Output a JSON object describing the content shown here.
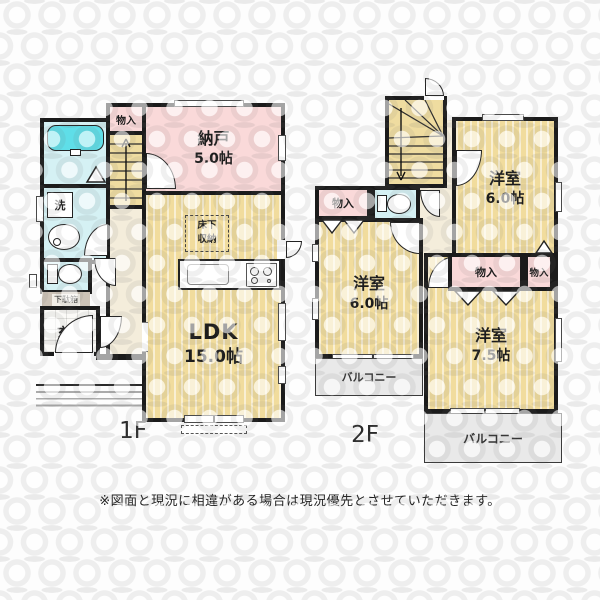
{
  "floors": {
    "f1": {
      "label": "1F",
      "closet": "物入",
      "nando": {
        "name": "納戸",
        "size": "5.0帖"
      },
      "ldk": {
        "name": "LDK",
        "size": "15.0帖"
      },
      "underfloor": {
        "line1": "床下",
        "line2": "収納"
      },
      "wash": "洗",
      "shoebox": "下駄箱",
      "entrance": "玄関"
    },
    "f2": {
      "label": "2F",
      "closet_left": "物入",
      "closet_c1": "物入",
      "closet_c2": "物入",
      "room_tr": {
        "name": "洋室",
        "size": "6.0帖"
      },
      "room_bl": {
        "name": "洋室",
        "size": "6.0帖"
      },
      "room_br": {
        "name": "洋室",
        "size": "7.5帖"
      },
      "balcony_left": "バルコニー",
      "balcony_bottom": "バルコニー"
    }
  },
  "footer": {
    "note": "※図面と現況に相違がある場合は現況優先とさせていただきます。"
  },
  "colors": {
    "room_yellow": "#F1DC9D",
    "closet_pink": "#FAD9D9",
    "wet_area_cyan": "#D5F1F4",
    "bathtub_cyan": "#5FDEE8",
    "hall_cream": "#F4EDDB",
    "wall": "#1B1B1B",
    "balcony_gray": "#E9E9E9"
  }
}
